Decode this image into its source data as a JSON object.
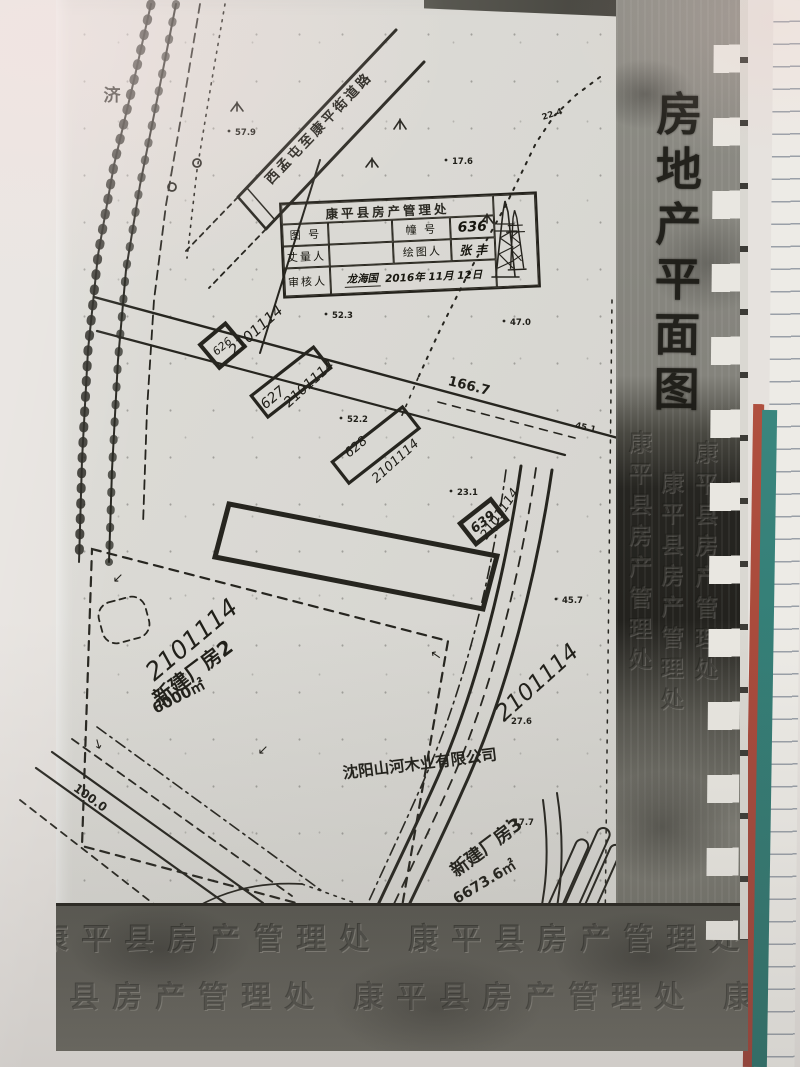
{
  "colors": {
    "desk_teal": "#2f7d76",
    "book_red": "#a7463b",
    "paper_gray": "#d9d8d3",
    "band_dark": "#23221e"
  },
  "title_band": {
    "title": "房地产平面图"
  },
  "stamp": {
    "office": "康平县房产管理处",
    "col_tu_hao": "图 号",
    "col_zhuang_hao": "幢 号",
    "zhuang_hao_value": "636",
    "col_zhangliang": "丈量人",
    "col_huitu": "绘图人",
    "huitu_value": "张 丰",
    "col_shenhe": "审核人",
    "shenhe_name": "龙海国",
    "date": "2016年 11月 12日"
  },
  "map": {
    "plot_number": "2101114",
    "road_band_text": "西孟屯至康平街道路",
    "left_road_char": "济",
    "corner_arrow": "↙",
    "buildings": {
      "b626": "626",
      "b627": "627",
      "b628": "628",
      "b639": "639"
    },
    "dims": {
      "d166": "166.7",
      "d100": "100.0",
      "d45": "45.1"
    },
    "factory2": {
      "name": "新建厂房2",
      "area": "6000㎡"
    },
    "factory3": {
      "name": "新建厂房3",
      "area": "6673.6㎡"
    },
    "company": "沈阳山河木业有限公司",
    "elev": {
      "e1": "57.9",
      "e2": "17.6",
      "e3": "22.4",
      "e4": "47.0",
      "e5": "52.3",
      "e6": "52.2",
      "e7": "23.1",
      "e8": "45.7",
      "e9": "27.6",
      "e10": "17.7"
    }
  },
  "watermark": {
    "text": "康平县房产管理处"
  }
}
